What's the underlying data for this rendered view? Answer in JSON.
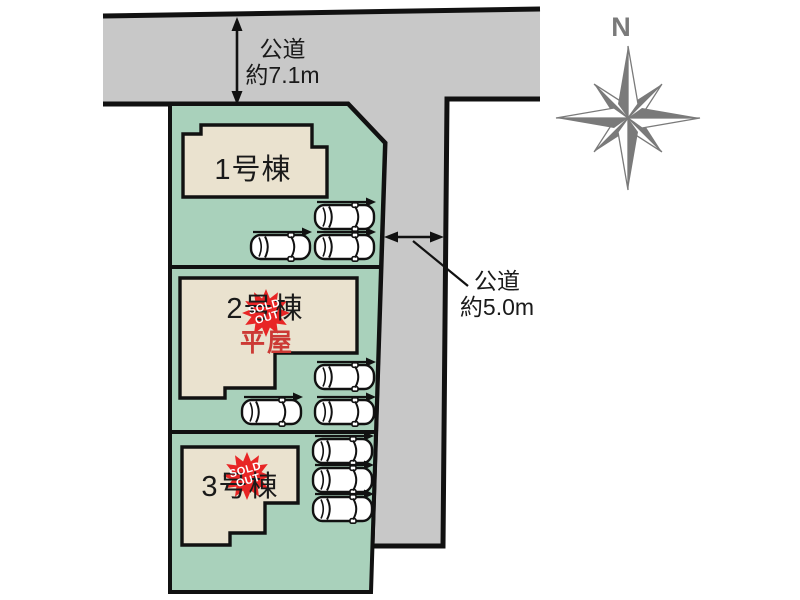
{
  "diagram_type": "residential-site-plan",
  "roads": {
    "top": {
      "name_label": "公道",
      "width_label": "約7.1m"
    },
    "side": {
      "name_label": "公道",
      "width_label": "約5.0m"
    }
  },
  "compass": {
    "north_label": "N"
  },
  "plots": [
    {
      "building_label": "1号棟",
      "sold_out": false,
      "car_count": 3
    },
    {
      "building_label": "2号棟",
      "type_label": "平屋",
      "sold_out": true,
      "badge": {
        "line1": "SOLD",
        "line2": "OUT"
      },
      "car_count": 3
    },
    {
      "building_label": "3号棟",
      "sold_out": true,
      "badge": {
        "line1": "SOLD",
        "line2": "OUT"
      },
      "car_count": 3
    }
  ],
  "colors": {
    "road_fill": "#c8c8c8",
    "plot_fill": "#a9d1bb",
    "building_fill": "#eae2cf",
    "outline": "#111111",
    "sold_badge_fill": "#e82525",
    "sold_badge_text": "#ffffff",
    "single_story_text": "#cc3a35",
    "compass_gray": "#7a7a7a"
  }
}
